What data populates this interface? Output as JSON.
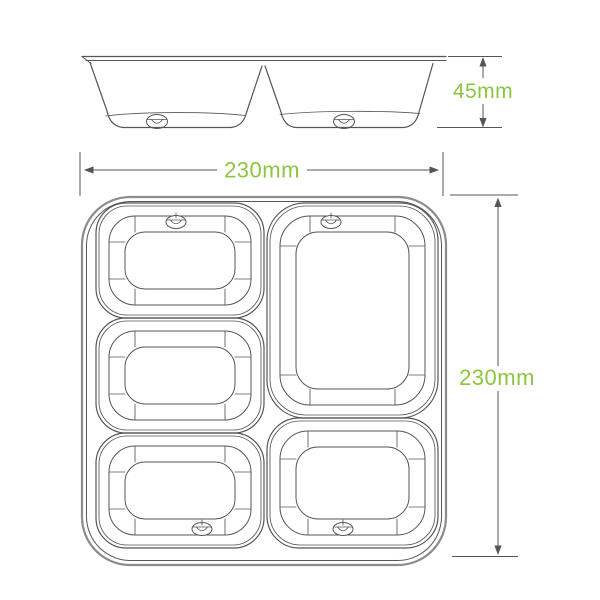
{
  "diagram": {
    "side_height_label": "45mm",
    "width_label": "230mm",
    "length_label": "230mm"
  },
  "colors": {
    "dimension_text": "#8CC63F",
    "drawing_line": "#55565A",
    "outer_edge": "#8A8C8E",
    "background": "#FFFFFF"
  }
}
